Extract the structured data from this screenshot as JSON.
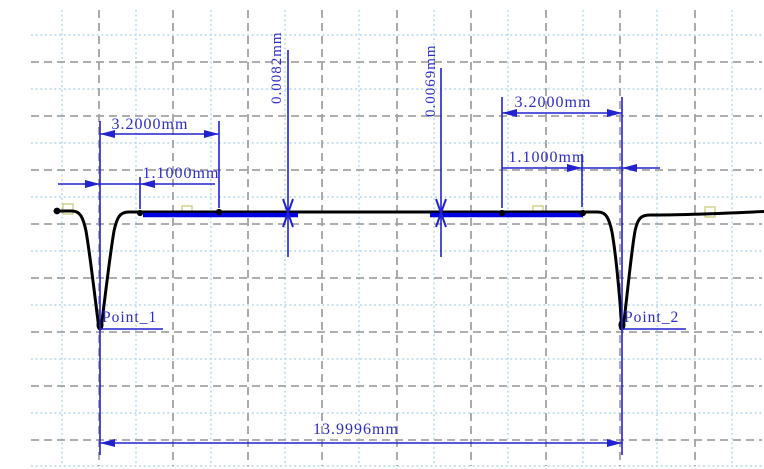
{
  "colors": {
    "background": "#ffffff",
    "annotation_blue": "#2222d0",
    "text_blue": "#2b2bc8",
    "reference_segment_blue": "#0000e0",
    "profile_black": "#000000",
    "grid_major_gray": "#a2a2a2",
    "grid_minor_lightblue": "#add6e8",
    "handle_pale_yellow": "#cfcf86"
  },
  "annotations": {
    "dim_left_width": "3.2000mm",
    "dim_left_offset": "1.1000mm",
    "dim_step_left": "0.0082mm",
    "dim_step_right": "0.0069mm",
    "dim_right_width": "3.2000mm",
    "dim_right_offset": "1.1000mm",
    "dim_overall": "13.9996mm",
    "point1": "Point_1",
    "point2": "Point_2"
  },
  "chart_data": {
    "type": "line",
    "title": "",
    "xlabel": "",
    "ylabel": "",
    "x_unit": "mm",
    "grid": "on",
    "legend": "none",
    "series": [
      {
        "name": "surface-profile-trace",
        "description": "Measured surface profile: flat surface with two narrow V-grooves; vertical scale display-exaggerated, no numeric axes shown",
        "groove_positions_mm": [
          0.0,
          13.9996
        ],
        "approx_trace_px": [
          [
            55,
            211
          ],
          [
            72,
            211
          ],
          [
            100,
            328
          ],
          [
            130,
            212
          ],
          [
            598,
            212
          ],
          [
            622,
            328
          ],
          [
            650,
            215
          ],
          [
            764,
            212
          ]
        ]
      }
    ],
    "reference_segments": [
      {
        "side": "left",
        "from_groove1_mm": [
          1.1,
          3.2
        ]
      },
      {
        "side": "right",
        "from_groove2_mm": [
          -3.2,
          -1.1
        ]
      }
    ],
    "measurements": [
      {
        "label": "3.2000mm",
        "kind": "horizontal-distance",
        "location": "left-of-groove-1"
      },
      {
        "label": "1.1000mm",
        "kind": "horizontal-distance",
        "location": "left-of-groove-1"
      },
      {
        "label": "0.0082mm",
        "kind": "height-step",
        "location": "left-segment-end"
      },
      {
        "label": "0.0069mm",
        "kind": "height-step",
        "location": "right-segment-start"
      },
      {
        "label": "3.2000mm",
        "kind": "horizontal-distance",
        "location": "right-of-groove-2"
      },
      {
        "label": "1.1000mm",
        "kind": "horizontal-distance",
        "location": "right-of-groove-2"
      },
      {
        "label": "13.9996mm",
        "kind": "horizontal-distance",
        "location": "groove-1-to-groove-2"
      }
    ],
    "points": [
      {
        "label": "Point_1",
        "x_mm": 0.0
      },
      {
        "label": "Point_2",
        "x_mm": 13.9996
      }
    ]
  }
}
